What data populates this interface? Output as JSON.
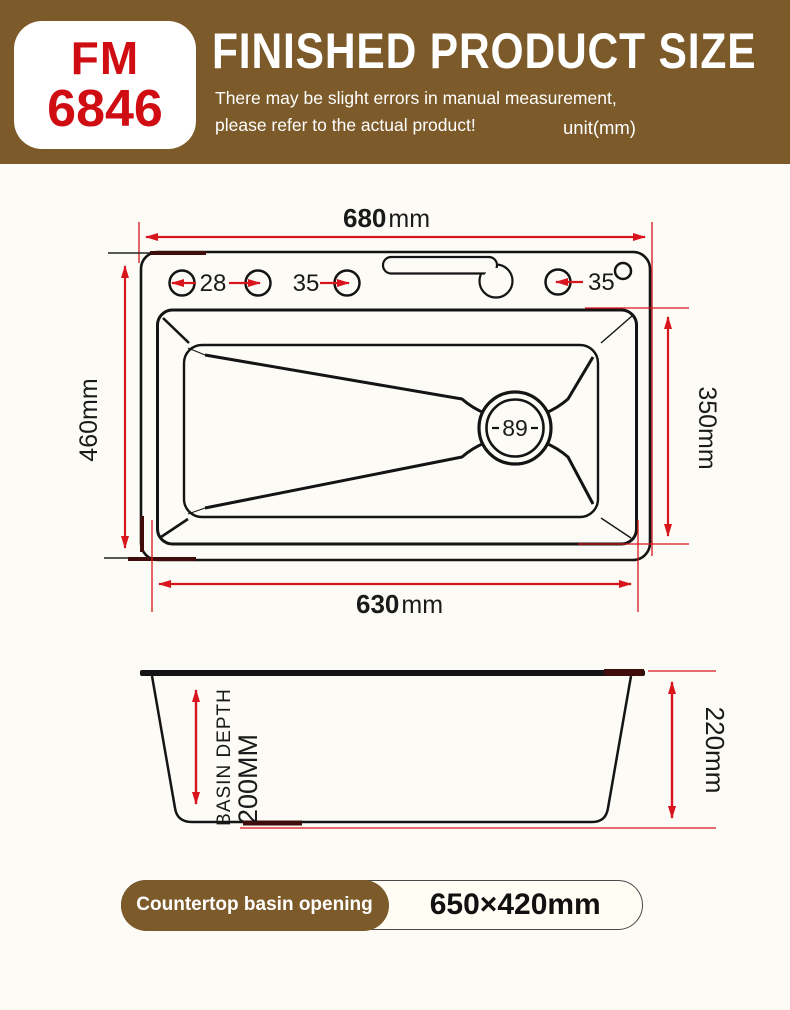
{
  "header": {
    "model_top": "FM",
    "model_bottom": "6846",
    "title": "FINISHED PRODUCT SIZE",
    "subtitle_line1": "There may be slight errors in manual measurement,",
    "subtitle_line2": "please refer to the actual product!",
    "unit_note": "unit(mm)"
  },
  "top_view": {
    "width_value": "680",
    "width_unit": "mm",
    "bottom_width_value": "630",
    "bottom_width_unit": "mm",
    "left_height": "460mm",
    "right_height": "350mm",
    "hole_dim_1": "28",
    "hole_dim_2": "35",
    "hole_dim_3": "35",
    "drain_diameter": "89"
  },
  "side_view": {
    "depth_label": "BASIN DEPTH",
    "depth_value": "200MM",
    "height_label": "220mm"
  },
  "footer": {
    "label": "Countertop basin opening",
    "value": "650×420mm"
  },
  "colors": {
    "brand_brown": "#7c5a29",
    "accent_red": "#d8141c",
    "model_red": "#cf0d13",
    "line_black": "#141414",
    "maroon_accent": "#400d0d"
  }
}
